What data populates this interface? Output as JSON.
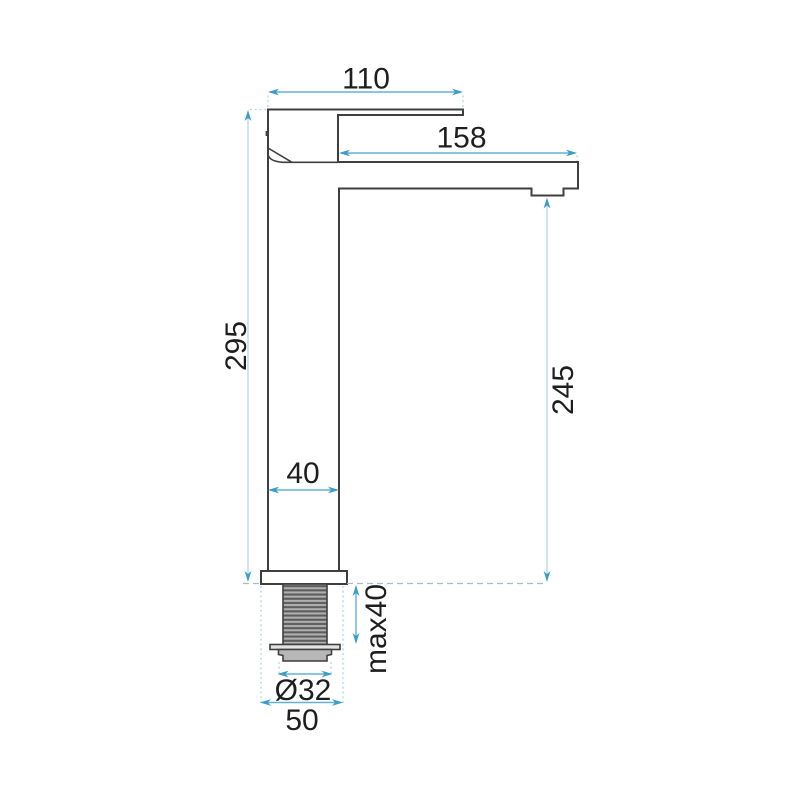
{
  "drawing": {
    "type": "technical-drawing",
    "subject": "tall single-lever basin mixer tap, side view with installation dimensions",
    "units": "mm",
    "dimensions": {
      "handle_length": "110",
      "spout_reach": "158",
      "total_height": "295",
      "outlet_height": "245",
      "body_depth": "40",
      "max_counter_thickness": "max40",
      "thread_diameter": "Ø32",
      "base_diameter": "50"
    },
    "colors": {
      "background": "#ffffff",
      "outline": "#3f3f3f",
      "dimension_line": "#63b1d4",
      "dimension_line_light": "#b3d7e5",
      "extension_line": "#a9d2e2",
      "countertop_line": "#9fbecd",
      "arrowhead": "#3e9dc7",
      "label_text": "#1e1e1e",
      "thread_light": "#b0b0b0",
      "thread_dark": "#5c5c5c",
      "washer_fill": "#e3e3e3",
      "nut_fill": "#b7b7b7"
    }
  }
}
